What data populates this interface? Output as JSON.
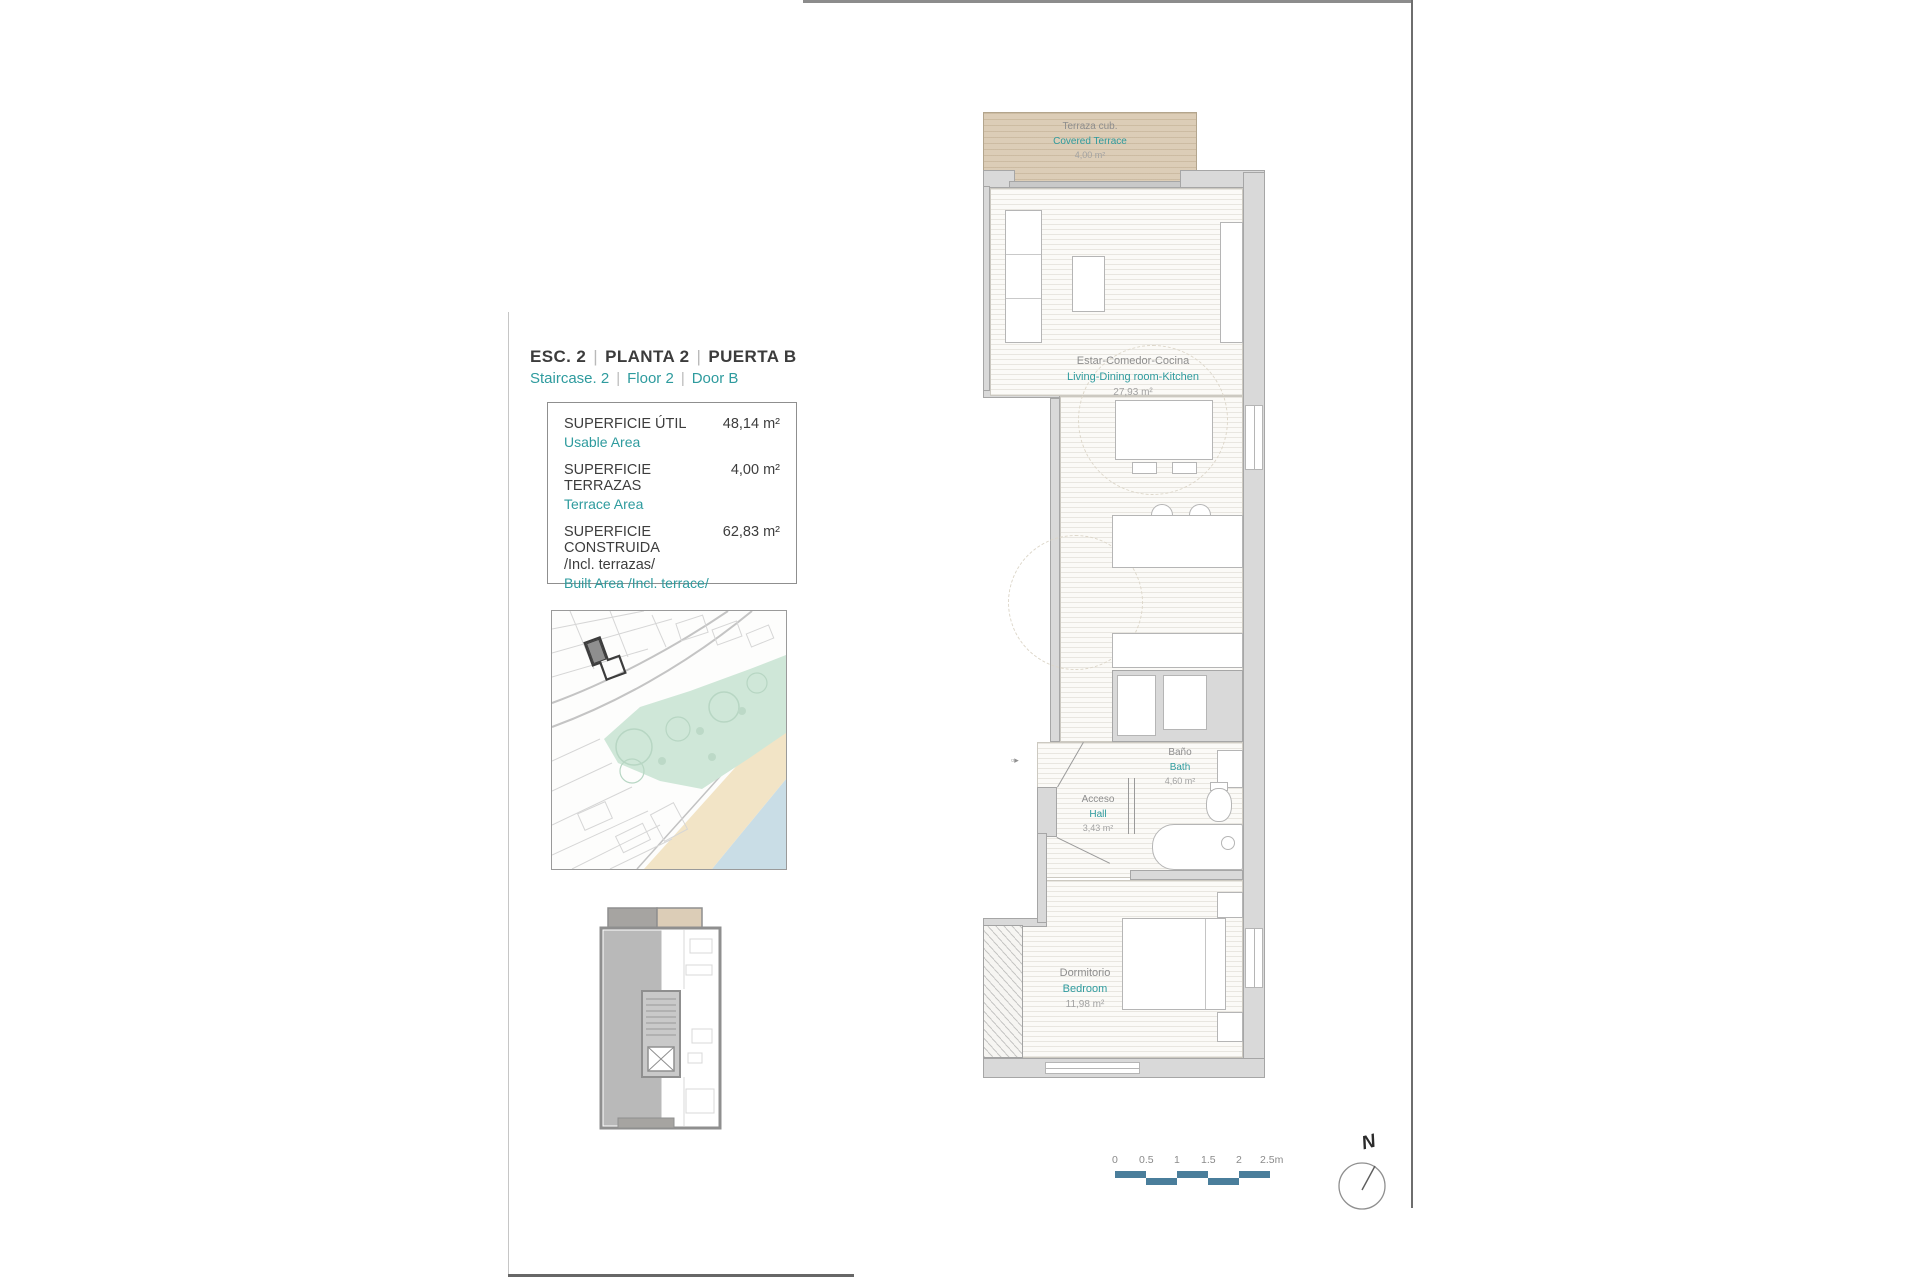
{
  "colors": {
    "teal_text": "#2E9B9E",
    "scale_bar": "#4A7E9B",
    "terrace_fill": "#DCCDB7",
    "wall_fill": "#D9D9D9",
    "park_green": "#CFE7D8",
    "beach_sand": "#F2E4C6",
    "sea_blue": "#C9DDE6"
  },
  "title": {
    "separator": "|",
    "es": [
      "ESC. 2",
      "PLANTA  2",
      "PUERTA B"
    ],
    "en": [
      "Staircase. 2",
      "Floor  2",
      "Door B"
    ]
  },
  "area_table": {
    "rows": [
      {
        "es": "SUPERFICIE ÚTIL",
        "en": "Usable Area",
        "value": "48,14 m²"
      },
      {
        "es": "SUPERFICIE TERRAZAS",
        "en": "Terrace Area",
        "value": "4,00 m²"
      },
      {
        "es": "SUPERFICIE CONSTRUIDA",
        "es_note": "/Incl. terrazas/",
        "en": "Built Area /Incl. terrace/",
        "value": "62,83 m²"
      }
    ]
  },
  "floorplan": {
    "rooms": [
      {
        "id": "covered-terrace",
        "es": "Terraza cub.",
        "en": "Covered Terrace",
        "area": "4,00 m²"
      },
      {
        "id": "living-dining-kitchen",
        "es": "Estar-Comedor-Cocina",
        "en": "Living-Dining room-Kitchen",
        "area": "27,93 m²"
      },
      {
        "id": "bath",
        "es": "Baño",
        "en": "Bath",
        "area": "4,60 m²"
      },
      {
        "id": "hall",
        "es": "Acceso",
        "en": "Hall",
        "area": "3,43 m²"
      },
      {
        "id": "bedroom",
        "es": "Dormitorio",
        "en": "Bedroom",
        "area": "11,98 m²"
      }
    ]
  },
  "scale_bar": {
    "ticks": [
      "0",
      "0.5",
      "1",
      "1.5",
      "2",
      "2.5m"
    ]
  },
  "compass": {
    "label": "N"
  }
}
